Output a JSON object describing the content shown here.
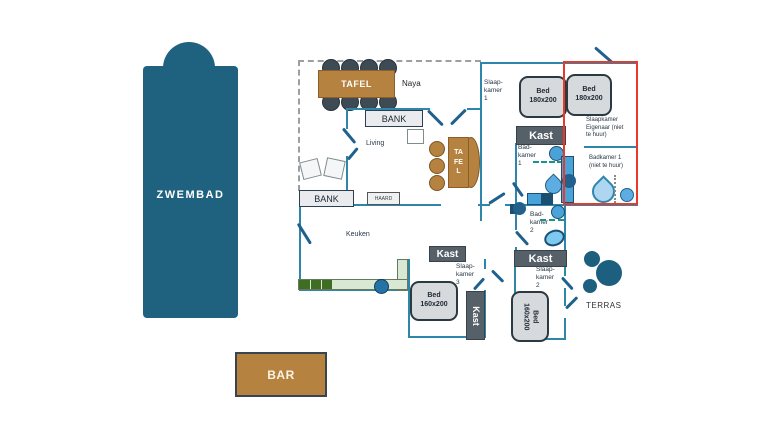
{
  "pool": {
    "label": "ZWEMBAD"
  },
  "bar": {
    "label": "BAR"
  },
  "naya": {
    "label": "Naya",
    "table_label": "TAFEL"
  },
  "living": {
    "label": "Living",
    "bank_label": "BANK",
    "dining_table_label": "TAFEL"
  },
  "kitchen": {
    "label": "Keuken",
    "bank_label": "BANK",
    "fireplace_label": "HAARD"
  },
  "bedroom1": {
    "label": "Slaap-\nkamer\n1",
    "bed_label": "Bed\n180x200",
    "closet_label": "Kast"
  },
  "bedroom2": {
    "label": "Slaap-\nkamer\n2",
    "bed_label": "Bed\n160x200",
    "closet_label": "Kast"
  },
  "bedroom3": {
    "label": "Slaap-\nkamer\n3",
    "bed_label": "Bed\n160x200",
    "closet_top_label": "Kast",
    "closet_side_label": "Kast"
  },
  "bathroom1": {
    "label": "Bad-\nkamer\n1"
  },
  "bathroom2": {
    "label": "Bad-\nkamer\n2"
  },
  "owner_bedroom": {
    "label": "Slaapkamer\nEigenaar (niet\nte huur)",
    "bed_label": "Bed\n180x200"
  },
  "owner_bathroom": {
    "label": "Badkamer 1\n(niet te huur)"
  },
  "terras": {
    "label": "TERRAS"
  },
  "colors": {
    "pool": "#1f627f",
    "wood": "#b5823f",
    "wall": "#2e86ab",
    "door": "#1f618d",
    "red_outline": "#e8392b",
    "closet": "#566068",
    "bed_fill": "#d7dadd",
    "bed_border": "#2b3942",
    "counter_light": "#d9e8d3",
    "counter_dark": "#3f6d22",
    "fixture_blue": "#4aa3d8",
    "fixture_dark": "#1b4f72",
    "fixture_light": "#aed6f1",
    "terras_circle": "#1d5f7e",
    "chair_dark": "#3f4b54"
  }
}
